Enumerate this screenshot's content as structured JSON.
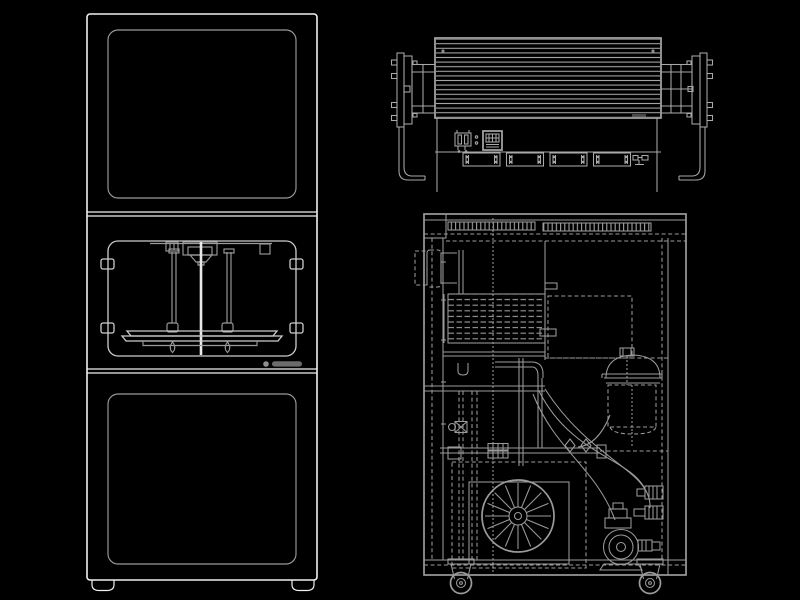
{
  "canvas": {
    "width": 800,
    "height": 600,
    "background": "#000000"
  },
  "palette": {
    "bg": "#000000",
    "line_bright": "#f0f0f0",
    "line_light": "#cdcdcd",
    "line_mid": "#9a9a9a",
    "line_draw": "#a9a9a9",
    "line_draw2": "#9b9b9b",
    "screw": "#e9e9e9",
    "logo": "#8f8f8f"
  },
  "views": [
    {
      "id": "front",
      "name": "enclosed-printer-front-elevation"
    },
    {
      "id": "top",
      "name": "finned-roller-unit-elevation"
    },
    {
      "id": "section",
      "name": "cabinet-internal-section-view"
    }
  ]
}
